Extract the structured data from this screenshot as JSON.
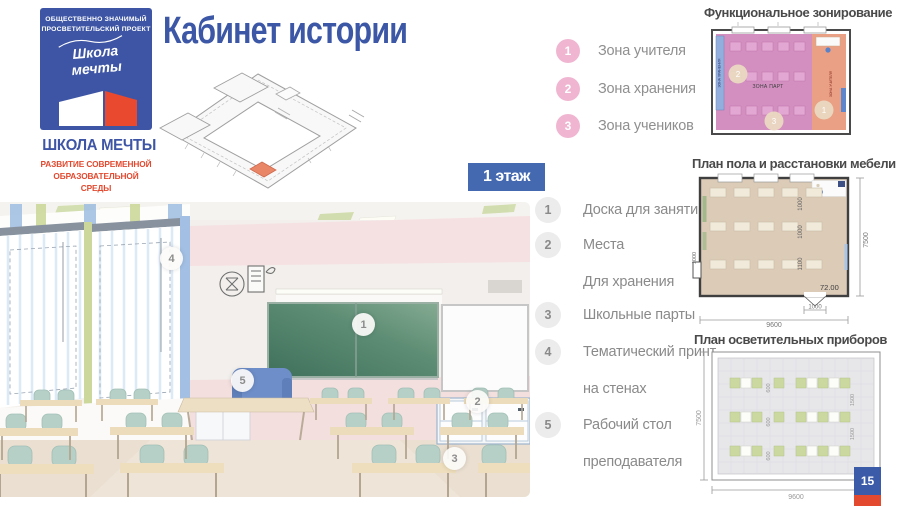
{
  "header": {
    "title": "Кабинет истории",
    "floor_badge": "1 этаж"
  },
  "logo": {
    "tagline_line1": "ОБЩЕСТВЕННО ЗНАЧИМЫЙ",
    "tagline_line2": "ПРОСВЕТИТЕЛЬСКИЙ ПРОЕКТ",
    "script_line1": "Школа",
    "script_line2": "мечты",
    "name": "ШКОЛА МЕЧТЫ",
    "subtitle_line1": "РАЗВИТИЕ СОВРЕМЕННОЙ",
    "subtitle_line2": "ОБРАЗОВАТЕЛЬНОЙ СРЕДЫ"
  },
  "zone_legend": {
    "items": [
      {
        "num": "1",
        "label": "Зона учителя"
      },
      {
        "num": "2",
        "label": "Зона хранения"
      },
      {
        "num": "3",
        "label": "Зона учеников"
      }
    ]
  },
  "feature_legend": {
    "items": [
      {
        "num": "1",
        "line1": "Доска для занятий",
        "line2": ""
      },
      {
        "num": "2",
        "line1": "Места",
        "line2": "Для хранения"
      },
      {
        "num": "3",
        "line1": "Школьные парты",
        "line2": ""
      },
      {
        "num": "4",
        "line1": "Тематический принт",
        "line2": "на стенах"
      },
      {
        "num": "5",
        "line1": "Рабочий стол",
        "line2": "преподавателя"
      }
    ]
  },
  "photo": {
    "markers": [
      {
        "num": "1"
      },
      {
        "num": "2"
      },
      {
        "num": "3"
      },
      {
        "num": "4"
      },
      {
        "num": "5"
      }
    ]
  },
  "zoning_plan": {
    "title": "Функциональное зонирование",
    "center_label": "ЗОНА ПАРТ",
    "storage_label": "ЗОНА ХРАНЕНИЯ",
    "teacher_label": "ЗОНА УЧИТЕЛЯ",
    "marker_teacher": "1",
    "marker_storage": "2",
    "marker_desks": "3"
  },
  "furniture_plan": {
    "title": "План пола и расстановки мебели",
    "width_dim": "9600",
    "height_dim": "7500",
    "area_label": "72.00",
    "aisle_dim_1": "1000",
    "aisle_dim_2": "1000",
    "aisle_dim_3": "1100",
    "door_dim": "1000",
    "left_door_dim": "1000"
  },
  "lighting_plan": {
    "title": "План осветительных приборов",
    "width_dim": "9600",
    "height_dim": "7500",
    "row1_600": "600",
    "row2_600": "600",
    "row3_600": "600",
    "gap_1500_a": "1500",
    "gap_1500_b": "1500"
  },
  "footer": {
    "page_number": "15"
  },
  "colors": {
    "accent_blue": "#3c57a6",
    "accent_red": "#e2492f",
    "zone_pink": "#d28fc0",
    "zone_teacher_salmon": "#e9a084",
    "zone_storage_blue": "#93aedd",
    "legend_pink_circle": "#f0b6d1",
    "legend_gray_circle": "#ececec",
    "text_gray": "#8a8a8a"
  }
}
